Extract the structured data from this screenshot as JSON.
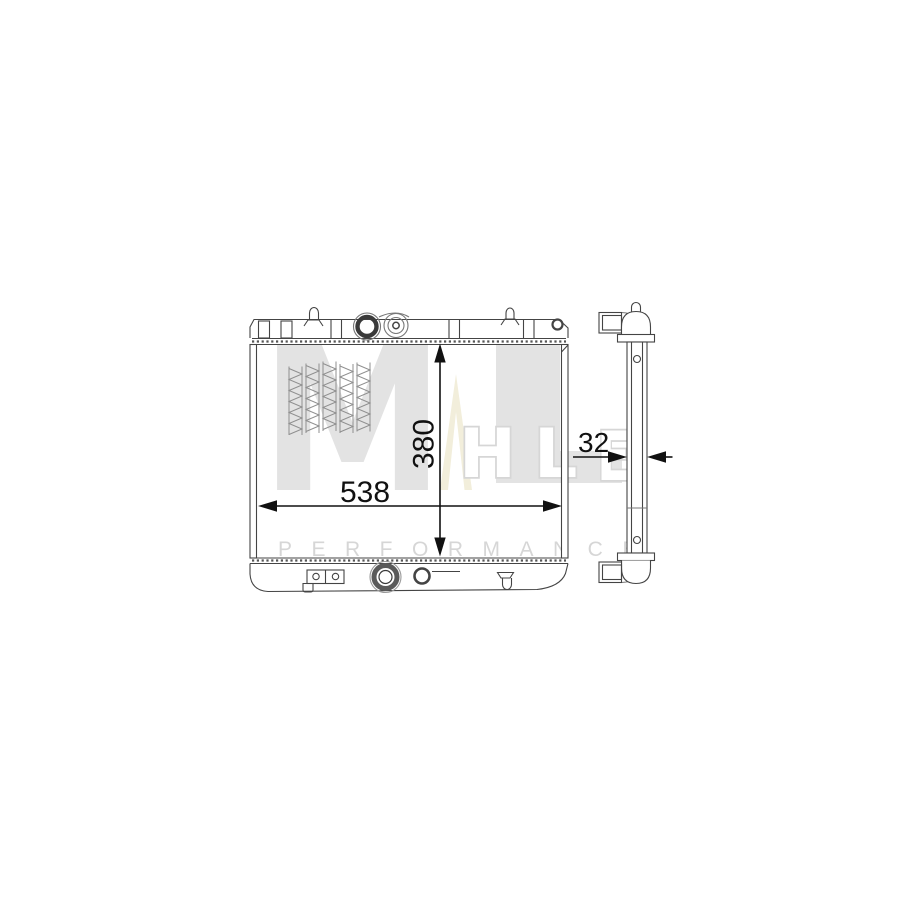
{
  "watermark": {
    "letter_m": "M",
    "letter_h": "H",
    "letter_l": "L",
    "letter_e": "E",
    "performance": "PERFORMANCE",
    "letter_color": "#e3e3e3",
    "hollow_letter_stroke": "#d6d6d6",
    "triangle_color": "#f2eedb",
    "performance_color": "#d6d6d6"
  },
  "dimensions": {
    "core_width": "538",
    "core_height": "380",
    "core_depth": "32"
  },
  "style": {
    "background": "#ffffff",
    "line_color": "#444444",
    "soft_line_color": "#777777",
    "dimension_color": "#111111"
  }
}
